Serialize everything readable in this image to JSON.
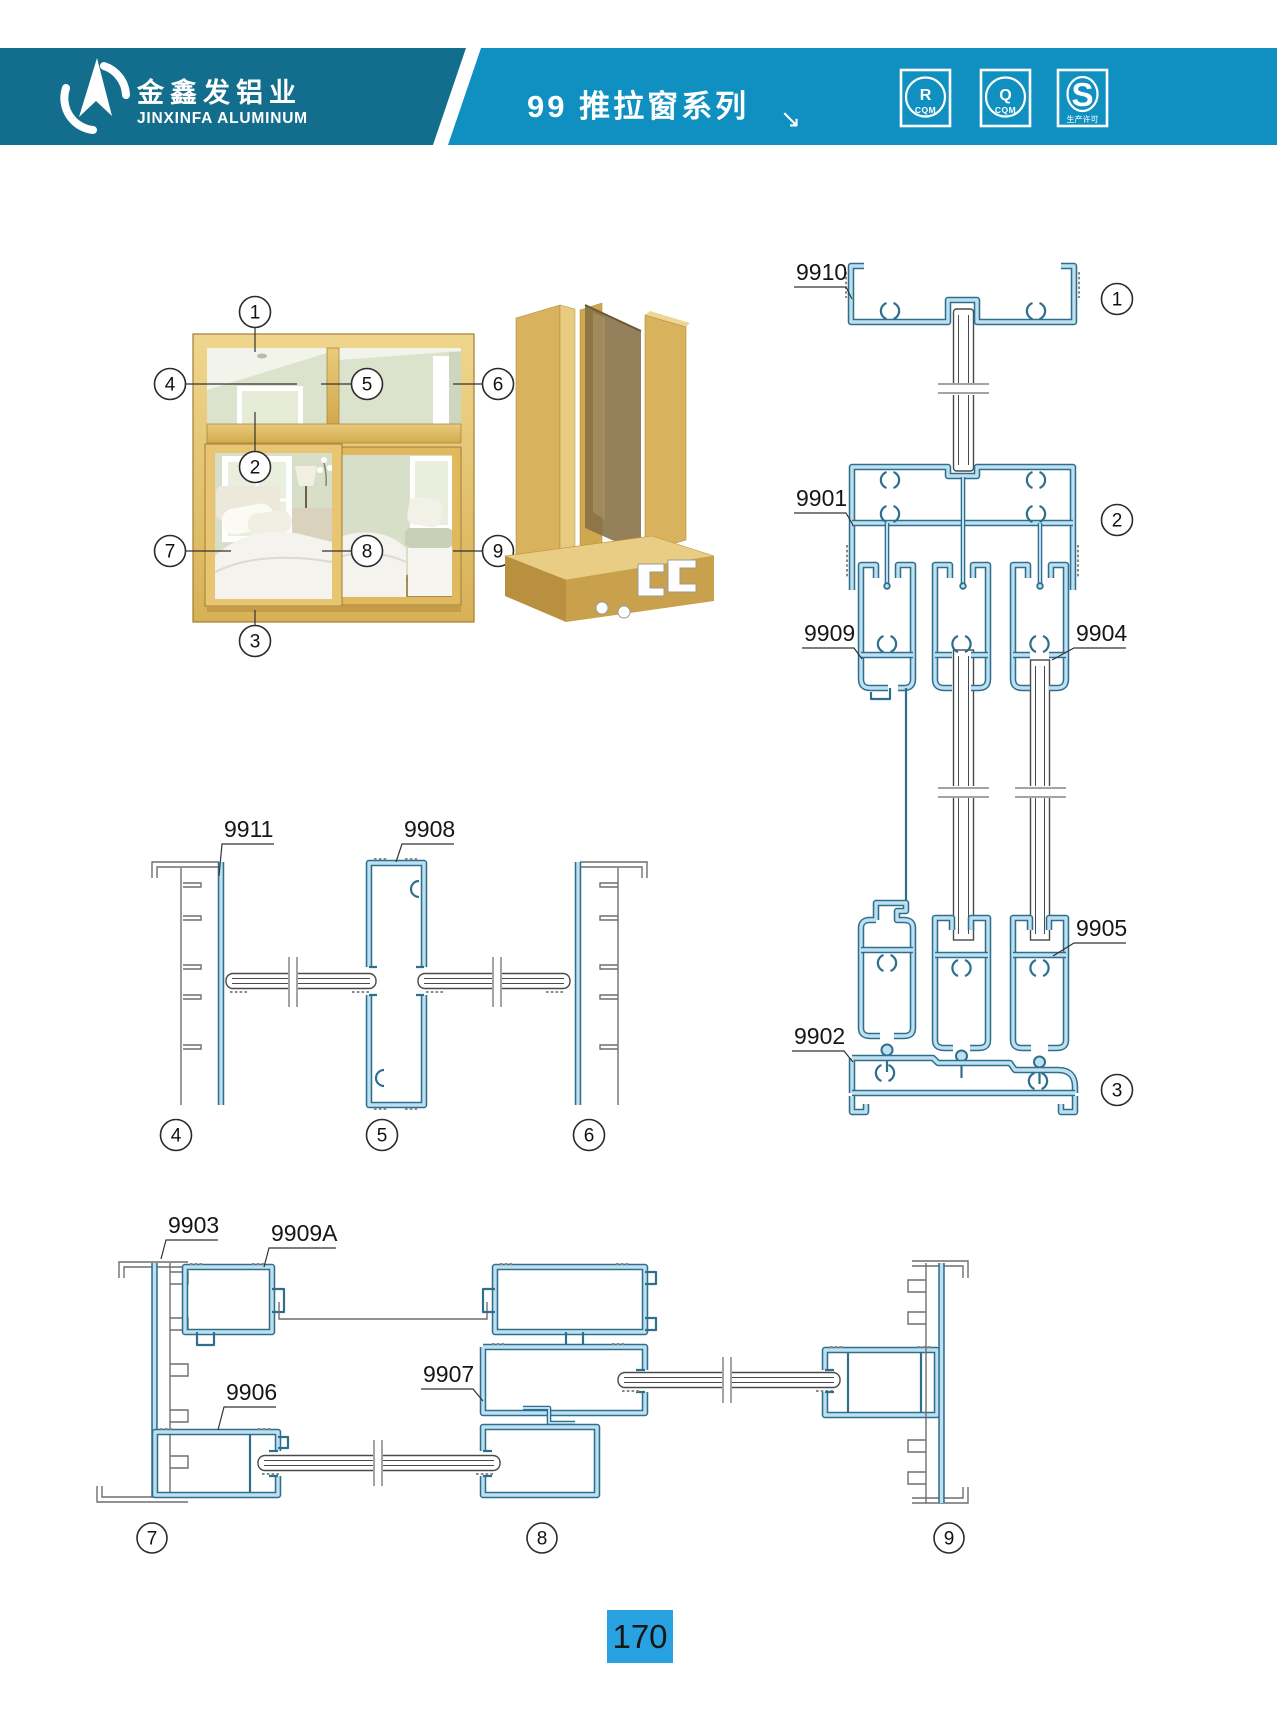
{
  "header": {
    "logo": {
      "company_cn": "金鑫发铝业",
      "company_en": "JINXINFA ALUMINUM"
    },
    "series_title": "99 推拉窗系列",
    "arrow_glyph": "↘",
    "badges": [
      {
        "symbol": "R",
        "label": "CQM"
      },
      {
        "symbol": "Q",
        "label": "CQM"
      },
      {
        "symbol": "S",
        "label": "生产许可"
      }
    ]
  },
  "figure": {
    "callouts": {
      "c1": "1",
      "c2": "2",
      "c3": "3",
      "c4": "4",
      "c5": "5",
      "c6": "6",
      "c7": "7",
      "c8": "8",
      "c9": "9"
    },
    "parts": {
      "p9910": "9910",
      "p9901": "9901",
      "p9909": "9909",
      "p9904": "9904",
      "p9905": "9905",
      "p9902": "9902",
      "p9911": "9911",
      "p9908": "9908",
      "p9903": "9903",
      "p9909a": "9909A",
      "p9906": "9906",
      "p9907": "9907"
    }
  },
  "footer": {
    "page_number": "170"
  },
  "colors": {
    "band_dark": "#136d8d",
    "band_light": "#0f90c0",
    "page_box": "#29a2e2",
    "profile_stroke": "#2e6f8e",
    "profile_fill": "#bfe0f0",
    "frame_gold": "#e5c271"
  }
}
